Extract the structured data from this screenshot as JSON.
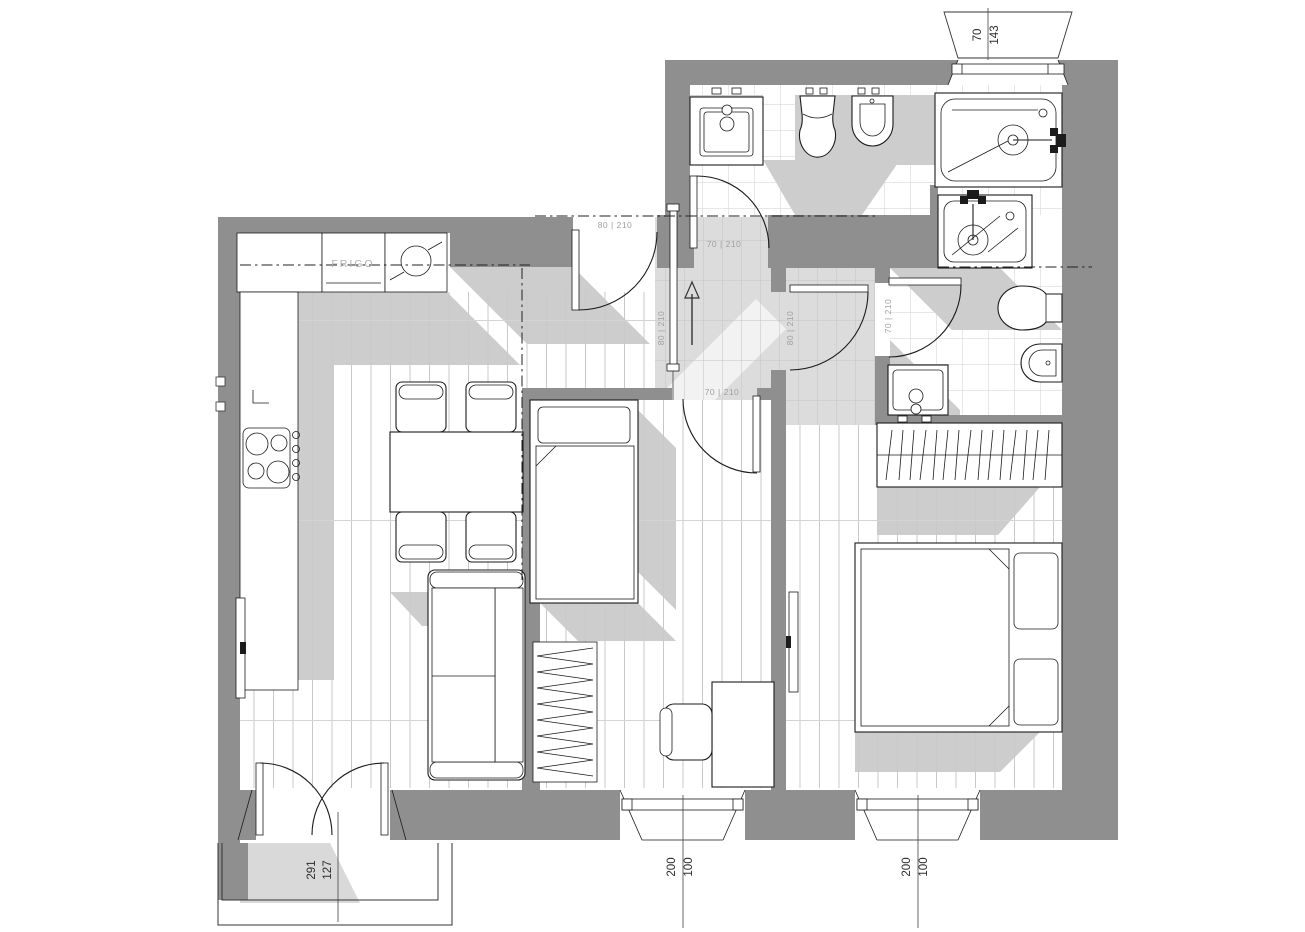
{
  "title": "Apartment floor plan",
  "labels": {
    "fridge": "FRIGO"
  },
  "door_tags": {
    "entry": "80 | 210",
    "bathroom": "70 | 210",
    "hall_sliding": "80 | 210",
    "corridor": "80 | 210",
    "bedroom_small": "70 | 210",
    "ensuite": "70 | 210"
  },
  "dimensions": {
    "north_window": [
      "70",
      "143"
    ],
    "balcony_door": [
      "127",
      "291"
    ],
    "south_window_left": [
      "100",
      "200"
    ],
    "south_window_right": [
      "100",
      "200"
    ]
  },
  "colors": {
    "wall": "#8f8f8f",
    "shadow": "#cdcdcd",
    "floor_line": "#c9c9c9",
    "paper": "#ffffff"
  }
}
